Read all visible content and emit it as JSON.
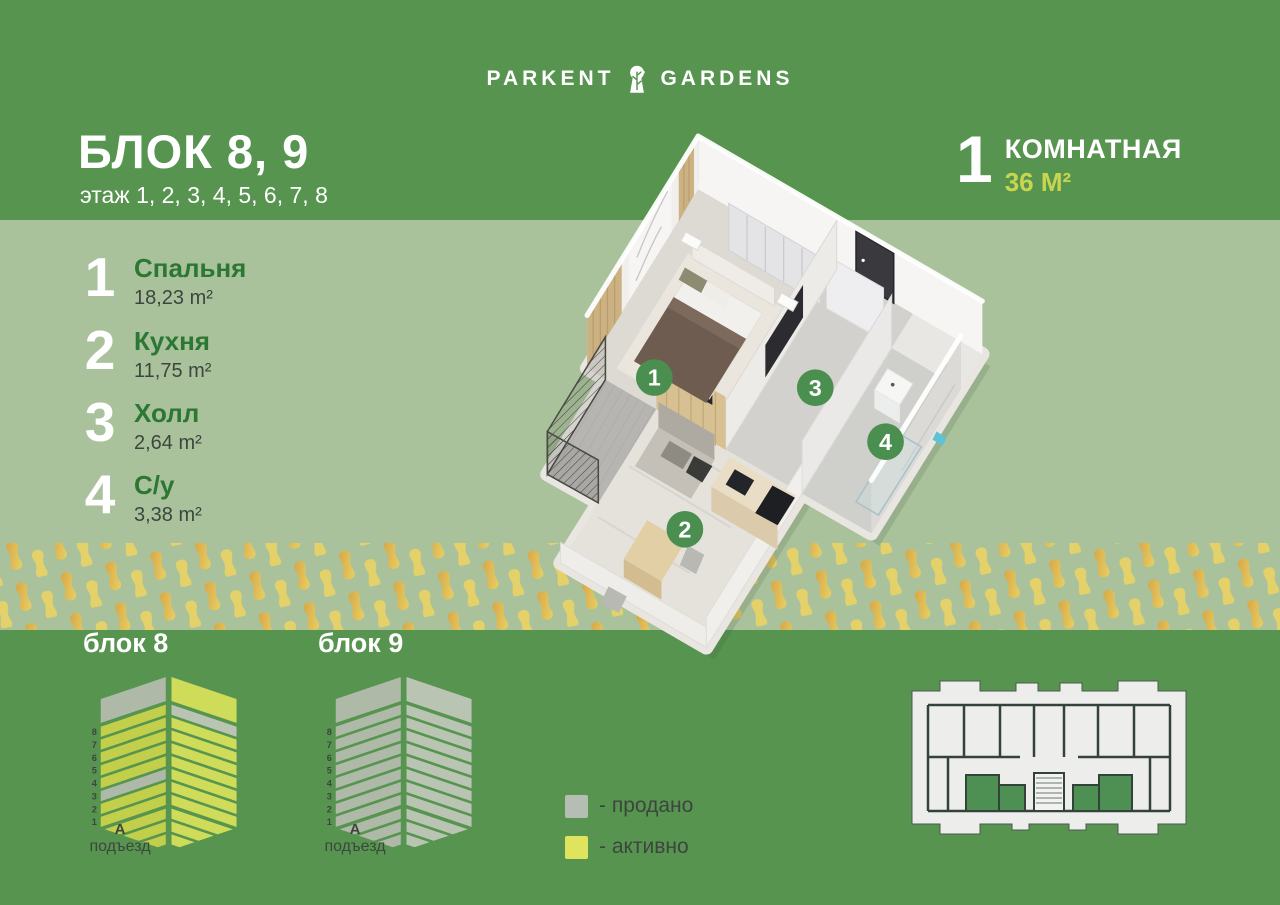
{
  "brand": {
    "name_left": "PARKENT",
    "name_right": "GARDENS"
  },
  "header": {
    "block_title": "БЛОК 8, 9",
    "floors_line": "этаж 1, 2, 3, 4, 5, 6, 7, 8",
    "rooms_count": "1",
    "rooms_label": "КОМНАТНАЯ",
    "area_label": "36 М²"
  },
  "room_list": [
    {
      "num": "1",
      "name": "Спальня",
      "area": "18,23 m²"
    },
    {
      "num": "2",
      "name": "Кухня",
      "area": "11,75 m²"
    },
    {
      "num": "3",
      "name": "Холл",
      "area": "2,64 m²"
    },
    {
      "num": "4",
      "name": "С/у",
      "area": "3,38 m²"
    }
  ],
  "plan_badges": [
    "1",
    "2",
    "3",
    "4"
  ],
  "blocks": [
    {
      "label": "блок 8",
      "entrance_letter": "А",
      "entrance_label": "подъезд",
      "floors": [
        "8",
        "7",
        "6",
        "5",
        "4",
        "3",
        "2",
        "1"
      ],
      "left": {
        "roof": "sold",
        "floors": [
          "active",
          "active",
          "active",
          "active",
          "active",
          "sold",
          "active",
          "active"
        ],
        "base": "active"
      },
      "right": {
        "roof": "active",
        "floors": [
          "sold",
          "active",
          "active",
          "active",
          "active",
          "active",
          "active",
          "active"
        ],
        "base": "active"
      }
    },
    {
      "label": "блок 9",
      "entrance_letter": "А",
      "entrance_label": "подъезд",
      "floors": [
        "8",
        "7",
        "6",
        "5",
        "4",
        "3",
        "2",
        "1"
      ],
      "left": {
        "roof": "sold",
        "floors": [
          "sold",
          "sold",
          "sold",
          "sold",
          "sold",
          "sold",
          "sold",
          "sold"
        ],
        "base": "sold"
      },
      "right": {
        "roof": "sold",
        "floors": [
          "sold",
          "sold",
          "sold",
          "sold",
          "sold",
          "sold",
          "sold",
          "sold"
        ],
        "base": "sold"
      }
    }
  ],
  "legend": [
    {
      "status": "sold",
      "label": "- продано"
    },
    {
      "status": "active",
      "label": "- активно"
    }
  ],
  "status_colors": {
    "sold": {
      "left": "#aeb9a8",
      "right": "#bac4b3"
    },
    "active": {
      "left": "#c2cf4a",
      "right": "#cfdc5a"
    }
  },
  "colors": {
    "green": "#579450",
    "sage": "#a9c29b",
    "accent": "#c8d64f",
    "room_name_green": "#2b7733",
    "dark_text": "#3c463e",
    "badge_green": "#4a8f4f",
    "legend_sold": "#b6bdb3",
    "legend_active": "#dfe35e",
    "plan_green": "#4e8f53",
    "gold": "#d7a647",
    "gold_light": "#e8d166"
  }
}
